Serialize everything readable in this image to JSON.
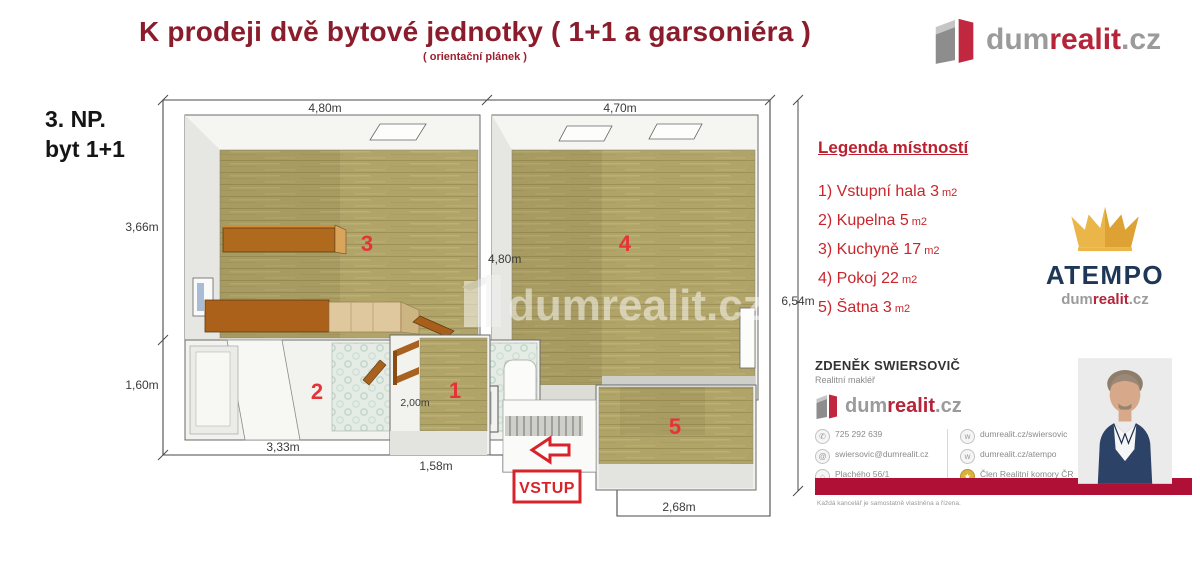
{
  "header": {
    "title": "K prodeji dvě bytové jednotky ( 1+1 a garsoniéra )",
    "subtitle": "( orientační plánek )"
  },
  "brand": {
    "dum": "dum",
    "realit": "realit",
    "cz": ".cz"
  },
  "floor_label": {
    "line1": "3. NP.",
    "line2": "byt 1+1"
  },
  "plan": {
    "watermark": "dumrealit.cz",
    "entrance_label": "VSTUP",
    "room_numbers": {
      "r1": "1",
      "r2": "2",
      "r3": "3",
      "r4": "4",
      "r5": "5"
    },
    "dims": {
      "top_left": "4,80m",
      "top_right": "4,70m",
      "left_upper": "3,66m",
      "left_lower": "1,60m",
      "right_side": "6,54m",
      "room4_left": "4,80m",
      "bottom_left": "3,33m",
      "hall_side": "2,00m",
      "hall_bottom": "1,58m",
      "bottom_right": "2,68m"
    }
  },
  "legend": {
    "title": "Legenda místností",
    "items": [
      {
        "text": "1) Vstupní hala 3",
        "unit": "m2"
      },
      {
        "text": "2) Kupelna 5",
        "unit": "m2"
      },
      {
        "text": "3) Kuchyně 17",
        "unit": "m2"
      },
      {
        "text": "4) Pokoj 22",
        "unit": "m2"
      },
      {
        "text": "5) Šatna 3",
        "unit": "m2"
      }
    ]
  },
  "atempo": {
    "name": "ATEMPO"
  },
  "agent": {
    "name": "ZDENĚK SWIERSOVIČ",
    "role": "Realitní makléř",
    "phone": "725 292 639",
    "email": "swiersovic@dumrealit.cz",
    "address_line1": "Plachého 56/1",
    "address_line2": "370 01 České Budějovice",
    "web_profile": "dumrealit.cz/swiersovic",
    "web_office": "dumrealit.cz/atempo",
    "membership": "Člen Realitní komory ČR",
    "tagline": "Každá kancelář je samostatně vlastněna a řízena."
  },
  "colors": {
    "title_red": "#8b1c2c",
    "legend_red": "#c9252b",
    "accent_red": "#d8232a",
    "brand_red": "#c22740",
    "brand_gray": "#9a9a9a",
    "navy": "#1e3756",
    "gold": "#eab64a",
    "bar_red": "#b01035",
    "floor_tan": "#b1a469"
  }
}
